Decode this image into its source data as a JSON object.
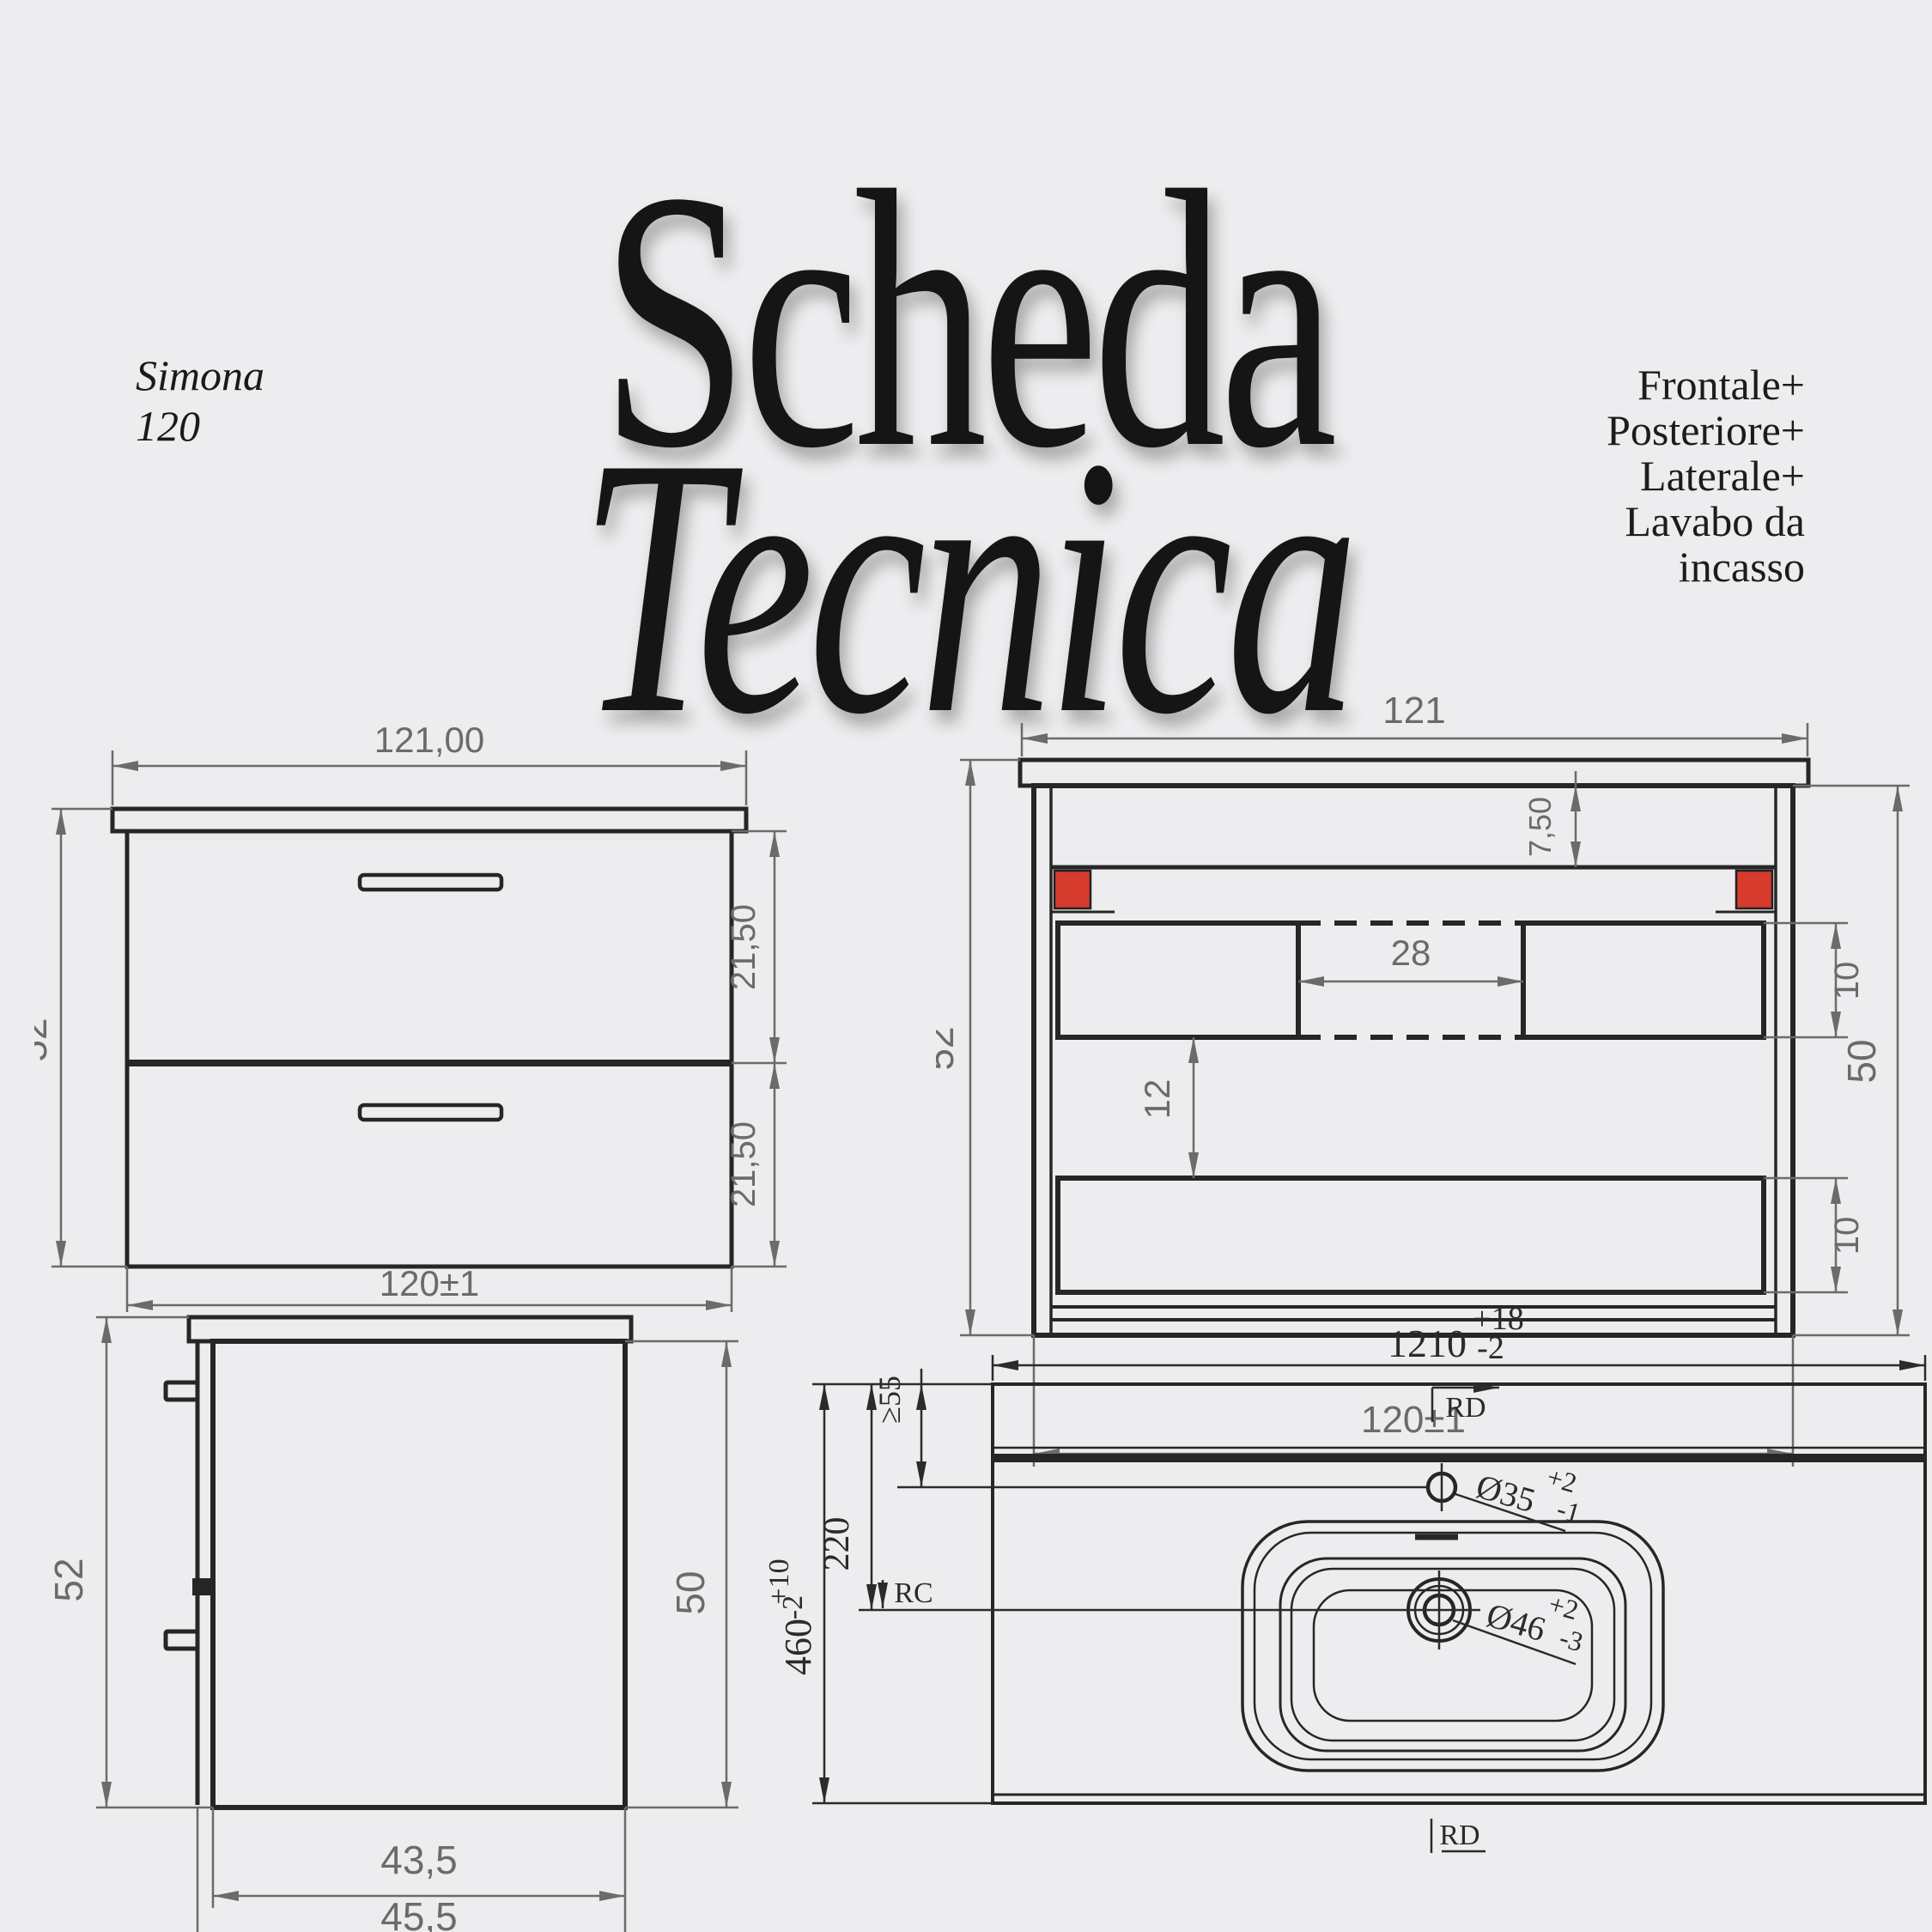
{
  "page": {
    "background": "#ededef"
  },
  "header": {
    "title_line1": "Scheda",
    "title_line2": "Tecnica",
    "product": {
      "line1": "Simona",
      "line2": "120"
    },
    "views_list": [
      "Frontale+",
      "Posteriore+",
      "Laterale+",
      "Lavabo da",
      "incasso"
    ]
  },
  "colors": {
    "accent_red": "#d63b2e",
    "line_dark": "#262626",
    "dim_gray": "#6b6b6b",
    "dim_dark": "#2b2b2b"
  },
  "front_view": {
    "width_top": "121,00",
    "height_left": "52",
    "drawer_top_height": "21,50",
    "drawer_bottom_height": "21,50",
    "width_bottom": "120±1"
  },
  "rear_view": {
    "width_top": "121",
    "height_left": "52",
    "rail_height": "7,50",
    "handle_gap": "28",
    "opening_top_height": "10",
    "spacing": "12",
    "opening_bottom_height": "10",
    "height_right": "50",
    "width_bottom": "120±1"
  },
  "side_view": {
    "height_left": "52",
    "height_right": "50",
    "depth_body": "43,5",
    "depth_total": "45,5"
  },
  "top_view": {
    "width": "1210",
    "width_tol_plus": "+18",
    "width_tol_minus": "-2",
    "edge_distance_min": "≥55",
    "faucet_offset": "220",
    "depth": "460",
    "depth_tol_plus": "+10",
    "depth_tol_minus": "-2",
    "datum_top": "RD",
    "datum_bottom": "RD",
    "reference": "RC",
    "faucet_hole_diameter": "Ø35",
    "faucet_tol_plus": "+2",
    "faucet_tol_minus": "-1",
    "drain_hole_diameter": "Ø46",
    "drain_tol_plus": "+2",
    "drain_tol_minus": "-3"
  }
}
